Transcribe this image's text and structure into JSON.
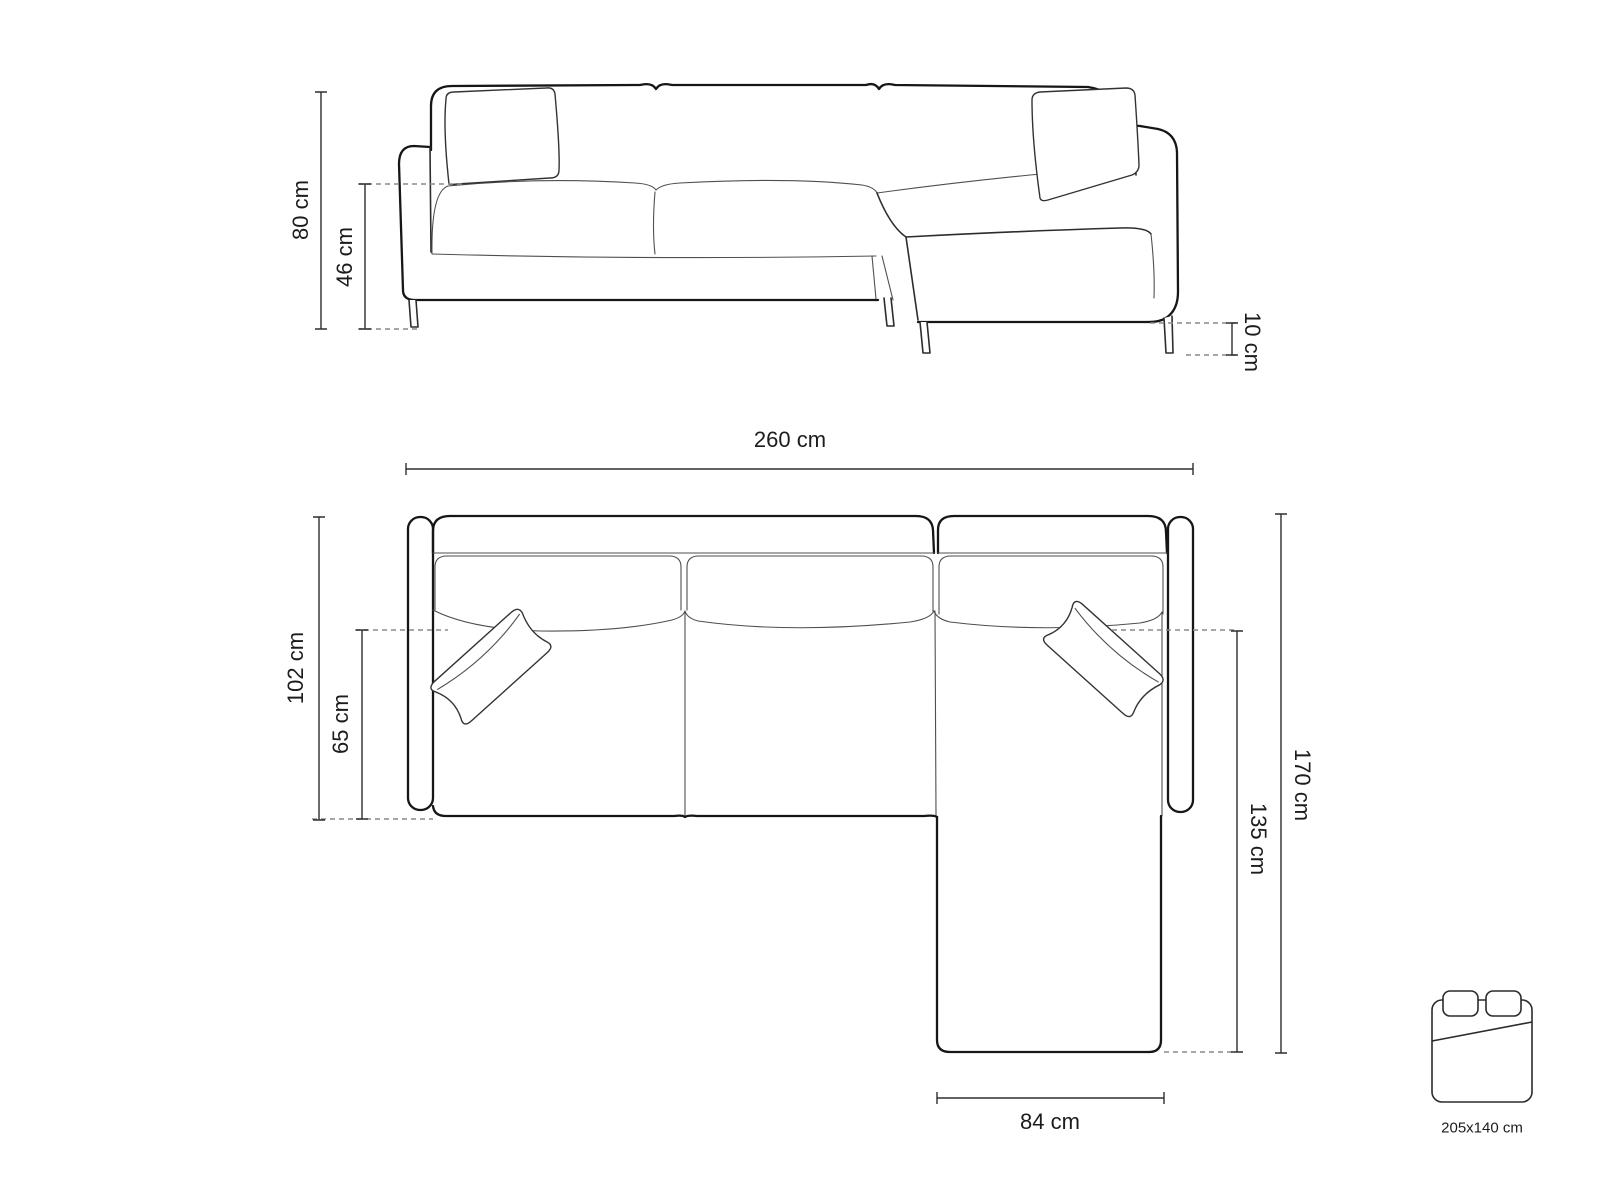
{
  "front_view": {
    "overall_height": "80 cm",
    "seat_height": "46 cm",
    "leg_height": "10 cm"
  },
  "top_view": {
    "overall_width": "260 cm",
    "overall_depth": "102 cm",
    "seat_depth": "65 cm",
    "overall_length": "170 cm",
    "chaise_length": "135 cm",
    "chaise_width": "84 cm"
  },
  "sleeping_area": {
    "icon": "bed-icon",
    "dimensions": "205x140 cm"
  },
  "colors": {
    "background": "#ffffff",
    "outline": "#161616",
    "detail_line": "#4f4f4f",
    "dimension_line": "#2e2e2e",
    "extension_dash": "#8a8a8a",
    "label_text": "#1c1c1c"
  }
}
